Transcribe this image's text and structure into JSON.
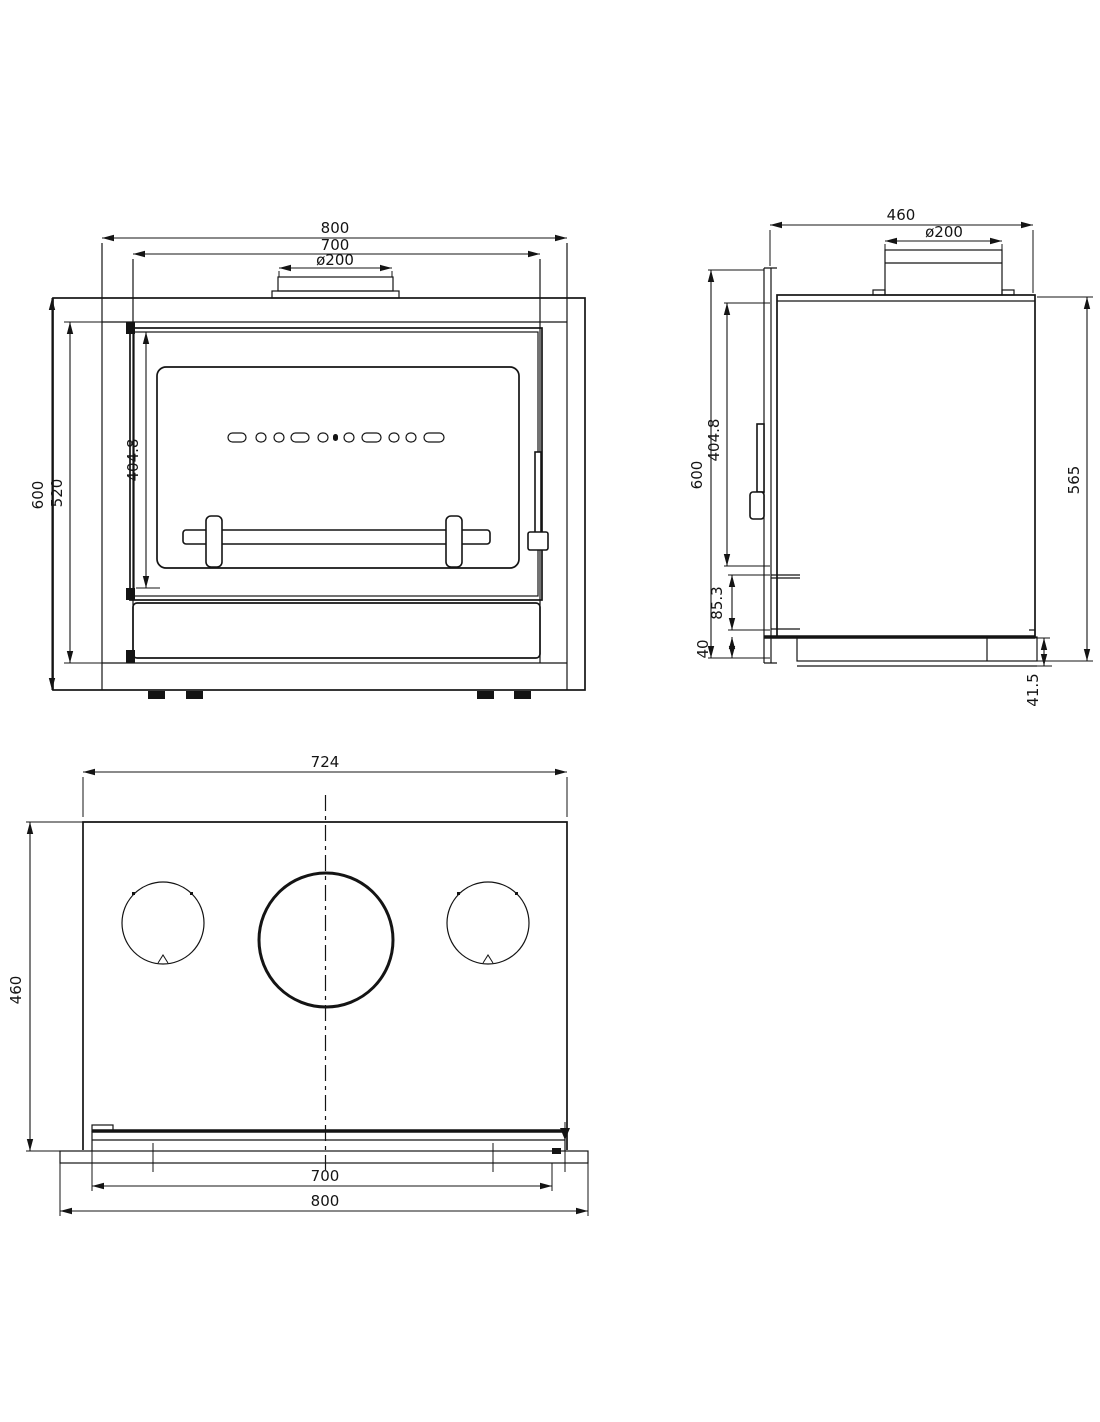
{
  "colors": {
    "line": "#141414",
    "background": "#ffffff"
  },
  "views": {
    "front": {
      "dims": {
        "overall_width": "800",
        "door_width": "700",
        "flue_diameter": "ø200",
        "overall_height": "600",
        "body_height": "520",
        "glass_height": "404.8"
      }
    },
    "side": {
      "dims": {
        "depth": "460",
        "flue_diameter": "ø200",
        "front_height": "600",
        "glass_height": "404.8",
        "ash_height": "85.3",
        "plinth_height": "40",
        "body_height": "565",
        "base_height": "41.5"
      }
    },
    "top": {
      "dims": {
        "body_width": "724",
        "depth": "460",
        "inner_width": "700",
        "front_width": "800"
      }
    }
  }
}
